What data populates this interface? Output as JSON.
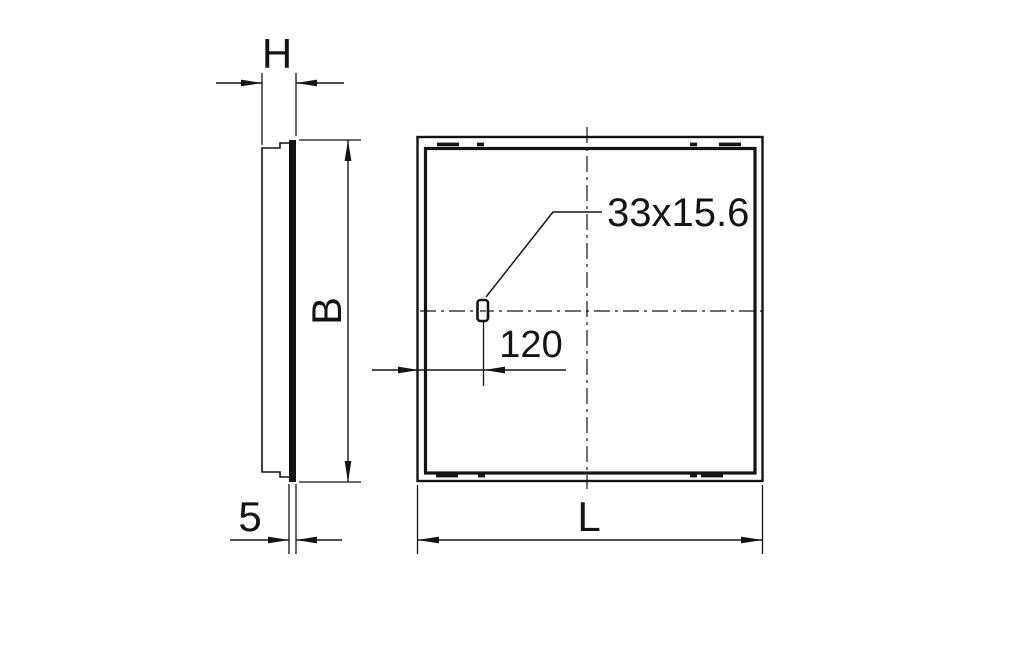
{
  "colors": {
    "background": "#ffffff",
    "line": "#141414"
  },
  "labels": {
    "depth": "H",
    "height": "B",
    "panel_thickness": "5",
    "width": "L",
    "cutout_offset": "120",
    "cutout_size": "33x15.6"
  }
}
